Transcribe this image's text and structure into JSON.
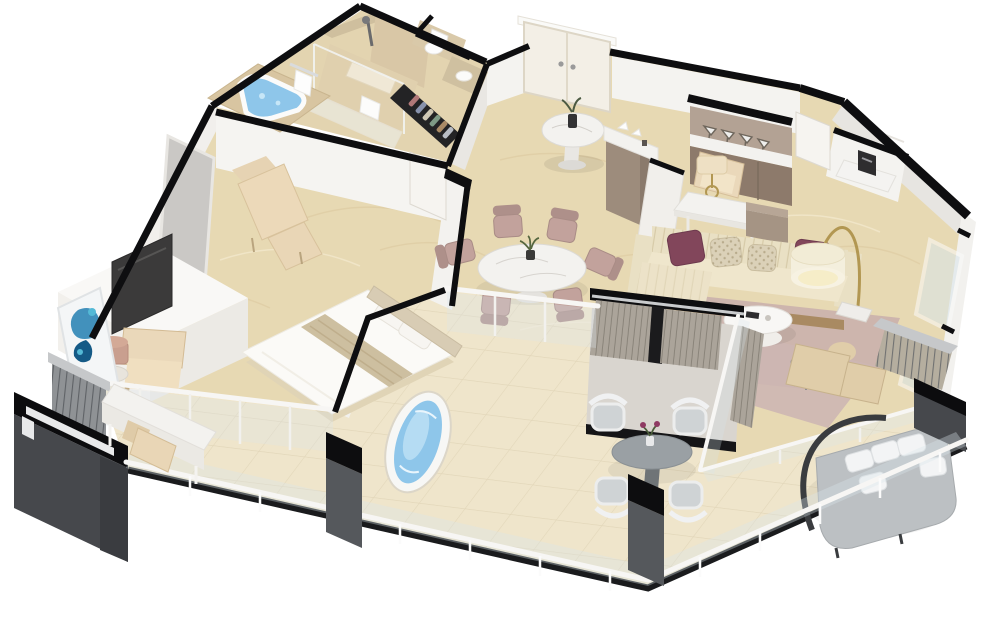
{
  "scene": {
    "title": "3D isometric cutaway floor plan of a one-bedroom suite with wraparound balcony",
    "render_style": "dollhouse 3D render on white background",
    "background": "#ffffff"
  },
  "rooms": [
    {
      "id": "bathroom",
      "label": "Bathroom",
      "furniture": [
        "corner jacuzzi tub",
        "walk-in glass shower",
        "shower bench",
        "towel rails",
        "toilet nook",
        "vanity counter"
      ]
    },
    {
      "id": "closet",
      "label": "Closet corridor",
      "furniture": [
        "hanging clothes rail"
      ]
    },
    {
      "id": "entry",
      "label": "Entry foyer",
      "furniture": [
        "double entry door",
        "round marble side table",
        "plant in black vase"
      ]
    },
    {
      "id": "bar",
      "label": "Bar / kitchenette",
      "furniture": [
        "glassware shelf",
        "marble bar counter",
        "taupe cabinets",
        "decor objects",
        "coffee station with machine"
      ]
    },
    {
      "id": "work-area",
      "label": "Work area",
      "furniture": [
        "marble writing desk",
        "beige armchair",
        "drum table lamp",
        "cube stool"
      ]
    },
    {
      "id": "dining",
      "label": "Dining area",
      "furniture": [
        "round marble dining table",
        "six dusty-rose chairs",
        "plant centerpiece"
      ]
    },
    {
      "id": "living",
      "label": "Living room",
      "furniture": [
        "striped cream sofa",
        "plum accent pillows",
        "patterned beige pillows",
        "brass arc floor lamp",
        "round white coffee table",
        "mauve area rug"
      ]
    },
    {
      "id": "sitting",
      "label": "Sitting corner",
      "furniture": [
        "rattan chaise with ottoman",
        "wire side table",
        "sheer striped curtains",
        "rose rug"
      ]
    },
    {
      "id": "bedroom",
      "label": "Bedroom",
      "furniture": [
        "bed with beige runner",
        "upholstered headboard",
        "white TV sideboard",
        "flat-screen TV",
        "beige armchair",
        "drum side table with rose lamp",
        "leaning blue abstract artwork",
        "marble vanity desk with chair",
        "chaise lounge with ottoman"
      ]
    },
    {
      "id": "balcony",
      "label": "Wraparound balcony",
      "furniture": [
        "oval soaking tub",
        "round outdoor dining table",
        "four white wicker chairs",
        "purple flower centerpiece",
        "round gray daybed with white pillows",
        "louvered privacy screens",
        "glass railing with white handrail",
        "structural pillars"
      ]
    }
  ],
  "palette": {
    "background": "#ffffff",
    "wall_cap": "#0e0e10",
    "wall_white": "#f4f3f0",
    "wall_shade": "#e7e5e1",
    "exterior_dark": "#46484c",
    "floor_interior": "#e7d9b3",
    "floor_balcony": "#efe5cb",
    "floor_bath": "#e3d4b0",
    "marble": "#f3f2ef",
    "water": "#8ec6ea",
    "water_light": "#c6e6f7",
    "sofa": "#e9e0c4",
    "pillow_plum": "#82465b",
    "pillow_beige": "#dbd1b8",
    "rug": "#cbb3ad",
    "chair_rose": "#c2a29c",
    "cabinet_taupe": "#8d7a6b",
    "counter_taupe": "#9d8c7c",
    "wood": "#a98a62",
    "armchair_beige": "#ead8ba",
    "chaise_rattan": "#e0cda9",
    "curtain": "#aba49a",
    "louver": "#8f9295",
    "daybed": "#bcc0c3",
    "outdoor_gray": "#9aa0a4",
    "tv": "#3b3a3a",
    "artwork_blue": "#2f86b5",
    "artwork_deep": "#155a86",
    "artwork_teal": "#54b9d6",
    "lamp_glow": "#f6edc8",
    "brass": "#b29752",
    "glass": "#d9e6ec"
  }
}
